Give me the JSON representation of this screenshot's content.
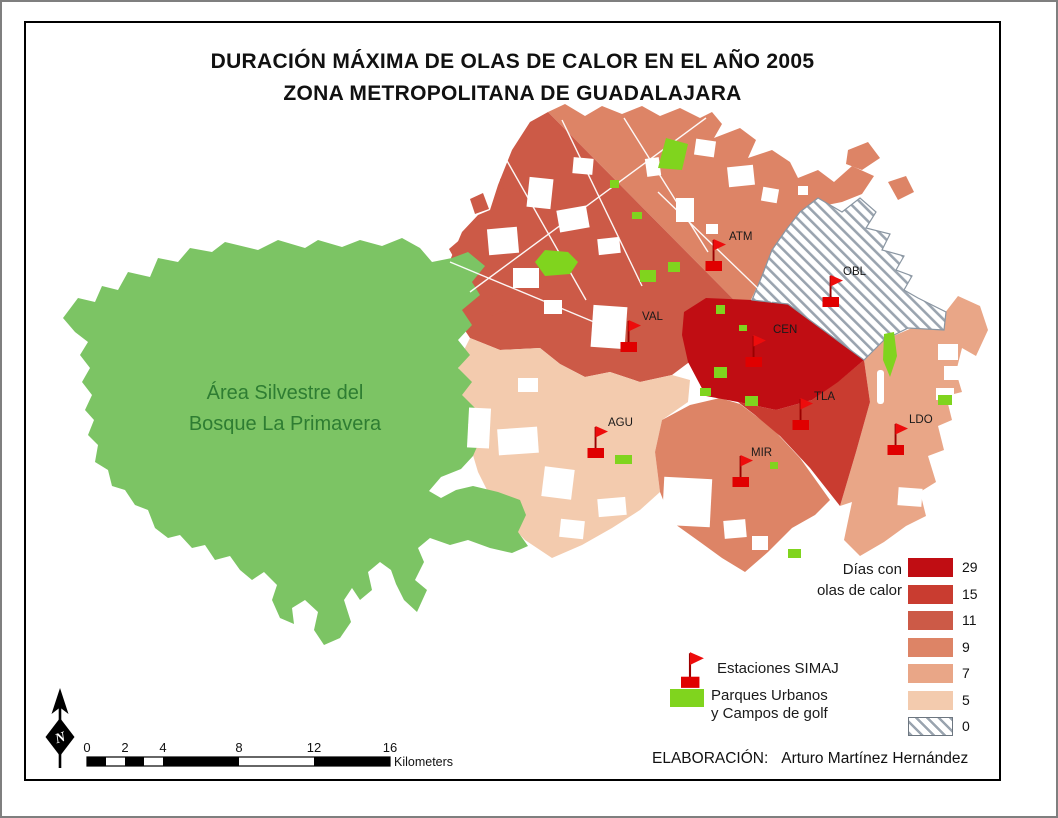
{
  "title": {
    "line1": "DURACIÓN MÁXIMA DE OLAS DE CALOR EN EL AÑO 2005",
    "line2": "ZONA METROPOLITANA DE GUADALAJARA"
  },
  "map": {
    "forest_label_line1": "Área Silvestre del",
    "forest_label_line2": "Bosque La Primavera",
    "stations": [
      {
        "label": "ATM"
      },
      {
        "label": "OBL"
      },
      {
        "label": "VAL"
      },
      {
        "label": "CEN"
      },
      {
        "label": "TLA"
      },
      {
        "label": "AGU"
      },
      {
        "label": "MIR"
      },
      {
        "label": "LDO"
      }
    ]
  },
  "legend": {
    "title_line1": "Días con",
    "title_line2": "olas de calor",
    "classes": [
      {
        "value": "29",
        "color": "#c00d13"
      },
      {
        "value": "15",
        "color": "#c93c30"
      },
      {
        "value": "11",
        "color": "#cc5a47"
      },
      {
        "value": "9",
        "color": "#dd8466"
      },
      {
        "value": "7",
        "color": "#e9a687"
      },
      {
        "value": "5",
        "color": "#f3cbae"
      },
      {
        "value": "0",
        "color": "hatched"
      }
    ],
    "stations_label": "Estaciones SIMAJ",
    "parks_label_line1": "Parques Urbanos",
    "parks_label_line2": "y Campos de golf"
  },
  "north": {
    "letter": "N"
  },
  "scalebar": {
    "ticks": [
      "0",
      "2",
      "4",
      "8",
      "12",
      "16"
    ],
    "unit": "Kilometers"
  },
  "credit": {
    "label": "ELABORACIÓN:",
    "author": "Arturo Martínez Hernández"
  },
  "colors": {
    "forest": "#7cc464",
    "forest_text": "#2e7d32",
    "park": "#80d41e",
    "flag": "#e60000",
    "hatch_stripe": "#9aa4af",
    "frame": "#000000"
  }
}
